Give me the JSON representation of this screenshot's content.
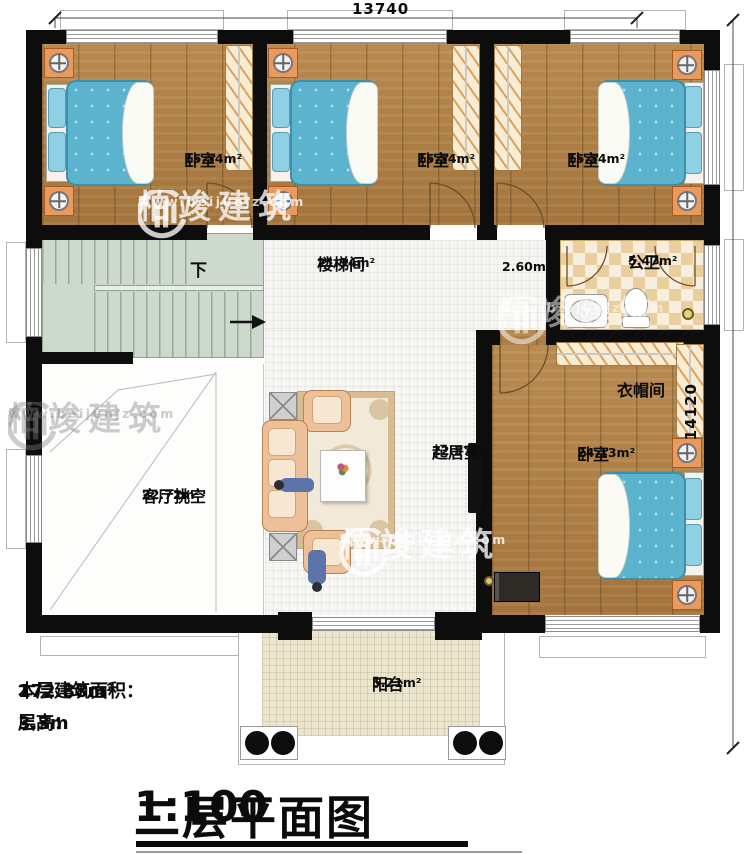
{
  "title": {
    "main": "二层平面图",
    "scale": "1:100"
  },
  "notes": {
    "area_label": "本层建筑面积：",
    "area_value": "172.88m²",
    "height_label": "层高：",
    "height_value": "3.3m"
  },
  "dimensions": {
    "width": "13740",
    "height": "14120"
  },
  "watermark": {
    "brand": "柏竣建筑",
    "url": "www.beijunjz.com"
  },
  "labels": {
    "down": "下"
  },
  "rooms": {
    "bedroom1": {
      "name": "卧室",
      "area": "15.54m²"
    },
    "bedroom2": {
      "name": "卧室",
      "area": "15.54m²"
    },
    "bedroom3": {
      "name": "卧室",
      "area": "15.54m²"
    },
    "bedroom4": {
      "name": "卧室",
      "area": "24.13m²"
    },
    "stairwell": {
      "name": "楼梯间",
      "area": "21.94m²"
    },
    "hallway": {
      "area": "2.60m²"
    },
    "bathroom": {
      "name": "公卫",
      "area": "5.47m²"
    },
    "cloakroom": {
      "name": "衣帽间"
    },
    "living": {
      "name": "起居室",
      "area": "22.57m²"
    },
    "void": {
      "name": "客厅挑空",
      "area": "22.72m²"
    },
    "balcony": {
      "name": "阳台",
      "area": "5.21m²"
    }
  },
  "colors": {
    "wall": "#0d0d0d",
    "wood_floor": "#b28349",
    "bed": "#5cb3cd",
    "tile": "#f6f6f3",
    "bath_checker": "#eacf9e",
    "stairs": "#cdd9cc",
    "balcony_floor": "#ece5cd",
    "sofa": "#eec09a",
    "nightstand": "#eb9a5d"
  }
}
